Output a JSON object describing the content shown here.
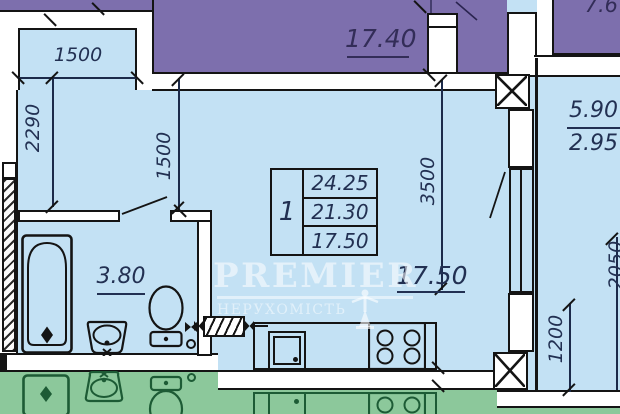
{
  "colors": {
    "room_fill": "#c3e1f4",
    "neighbor_top_fill": "#7d6fad",
    "neighbor_bottom_fill": "#8cc89b",
    "wall_fill": "#ffffff",
    "line": "#141414",
    "dim_text": "#223052",
    "purple_text": "#332d58",
    "green_line": "#1d5b35",
    "watermark": "rgba(255,255,255,0.55)"
  },
  "watermark": {
    "brand": "PREMIER",
    "subtitle": "НЕРУХОМІСТЬ",
    "statue_icon": "statue-icon"
  },
  "areas": {
    "neighbor_top": "17.40",
    "neighbor_top_right": "7.6",
    "right_room_total": "5.90",
    "right_room_half": "2.95",
    "main_room": "17.50",
    "bathroom": "3.80"
  },
  "unit_table": {
    "unit_number": "1",
    "rows": [
      "24.25",
      "21.30",
      "17.50"
    ]
  },
  "dims": {
    "balcony_width": "1500",
    "left_wall": "2290",
    "hall_width": "1500",
    "room_width": "3500",
    "right_room_height": "2050",
    "right_room_segment": "1200"
  }
}
